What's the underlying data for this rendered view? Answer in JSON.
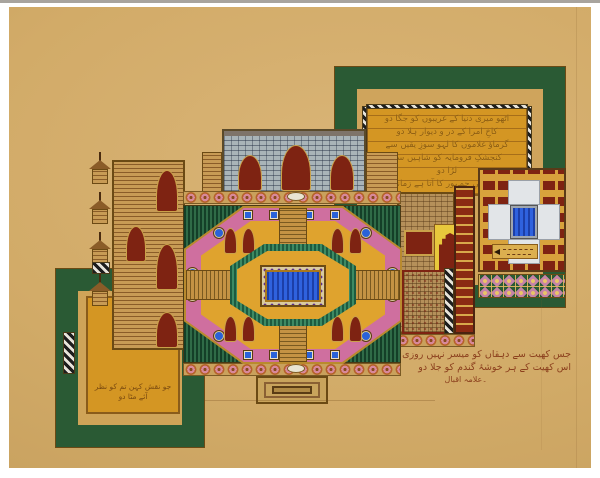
{
  "palette": {
    "paper": "#d2ab68",
    "photo_margin": "#ffffff",
    "gold_panel": "#d49623",
    "gold_trim": "#b98a2e",
    "maroon": "#7e2312",
    "dark_green": "#1e4d2f",
    "teal_green": "#2b6b50",
    "pink_ring": "#cf6f9f",
    "tile_pink": "#c684a6",
    "pool_blue": "#2a52d4",
    "ink_brown": "#8b3f1d",
    "gate_grey": "#a9b4b8"
  },
  "inscriptions": {
    "top_right_panel": {
      "lines": [
        "اٹھو میری دنیا کے غریبوں کو جگا دو",
        "کاخِ امرا کے در و دیوار ہلا دو",
        "گرماؤ غلاموں کا لہو سوزِ یقیں سے",
        "کنجشکِ فرومایہ کو شاہیں سے",
        "لڑا دو",
        "سلطانیِ جمہور کا آتا ہے زمانہ"
      ]
    },
    "bottom_left_panel": {
      "lines": [
        "جو نقش کہن تم کو نظر",
        "آئے مٹا دو"
      ]
    },
    "bottom_right_ink": {
      "lines": [
        "جس کھیت سے دہقاں کو میسر نہیں روزی",
        "اس کھیت کے ہر خوشۂ گندم کو جلا دو"
      ],
      "signature": "۔علامہ اقبال"
    }
  }
}
